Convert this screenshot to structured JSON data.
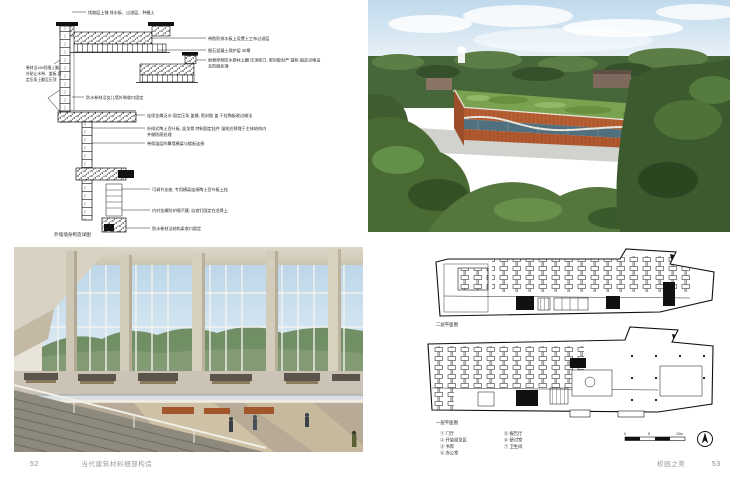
{
  "left_page": {
    "page_number": "52",
    "book_title": "当代建筑材料细部构造",
    "detail_drawing": {
      "caption": "外墙墙身构造详图",
      "annotations": {
        "top": "找坡层上铺 排水板、过滤层、种植土",
        "r1": "带肋防排水板上设置土工布过滤层",
        "r2": "细石混凝土保护层 40厚",
        "r3a": "耐根穿刺防水卷材上翻 压顶收口, 密封胶封严 锚栓-固定点埋设",
        "r3b": "及防腐处理",
        "l2a": "卷材沿±50挡墙上翻,",
        "l2b": "外贴止水带、盖板-固",
        "l2c": "定压条上翻至压顶",
        "l3": "防水卷材沿女儿墙外侧收口固定",
        "m1": "连续金属泛水-固定压条 盖缝, 密封胶 盖 干挂陶板收边做法",
        "m2a": "外倾式陶土百叶板, 竖龙骨 特制固定挂件 锚栓应预埋于主体结构内",
        "m2b": "并做防腐处理",
        "m3": "带保温层的幕墙横梁与楼板连接",
        "b1": "可调节支座, 专用横梁连接陶土百叶板上挂",
        "b2": "内衬金属防护隔汽膜, 自攻钉固定在龙骨上",
        "b3": "防水卷材沿结构梁收口固定"
      }
    }
  },
  "right_page": {
    "page_number": "53",
    "section_title": "校园之美",
    "plans": {
      "upper_label": "二层平面图",
      "lower_label": "一层平面图",
      "legend_col1": [
        "① 门厅",
        "② 开架阅览区",
        "③ 书库",
        "④ 办公室"
      ],
      "legend_col2": [
        "⑤ 报告厅",
        "⑥ 研讨室",
        "⑦ 卫生间"
      ],
      "scale_labels": {
        "start": "0",
        "mid": "5",
        "end": "10m"
      }
    }
  }
}
